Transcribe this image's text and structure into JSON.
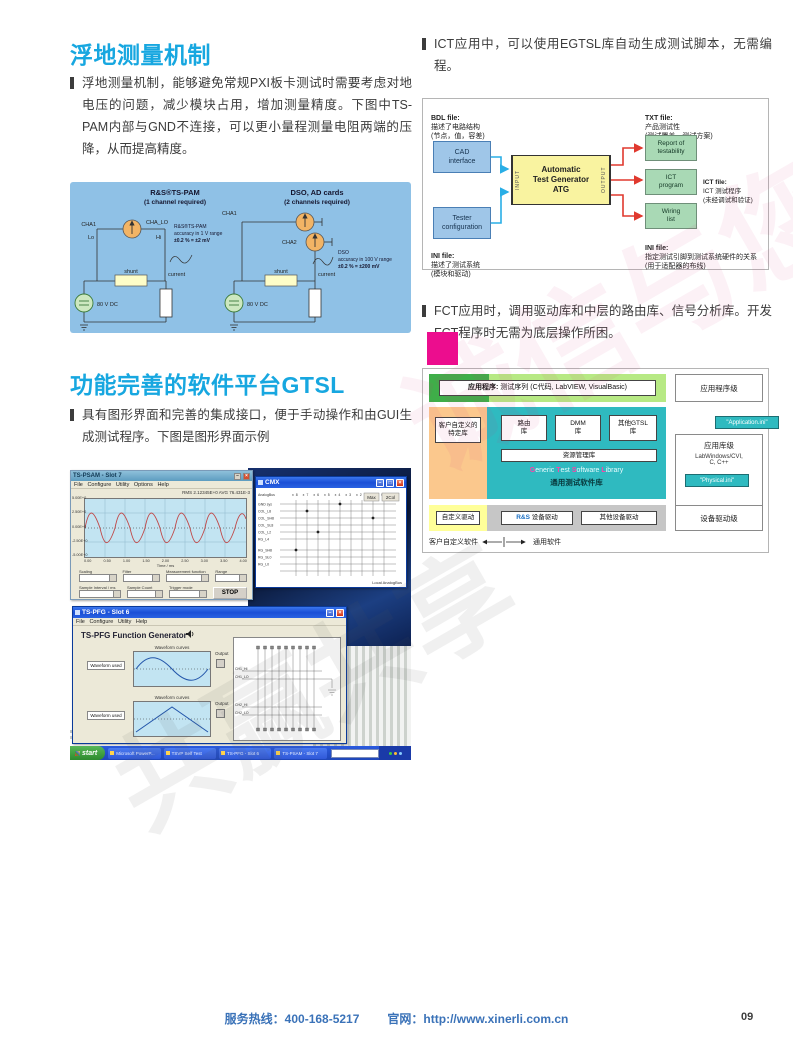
{
  "page": {
    "footer": {
      "hotline_label": "服务热线：",
      "hotline": "400-168-5217",
      "web_label": "官网：",
      "website": "http://www.xinerli.com.cn",
      "page_number": "09"
    },
    "watermark": {
      "line1": "诚信与您",
      "line2": "共赢共享"
    }
  },
  "left": {
    "section1": {
      "title": "浮地测量机制",
      "body": "浮地测量机制，能够避免常规PXI板卡测试时需要考虑对地电压的问题，减少模块占用，增加测量精度。下图中TS-PAM内部与GND不连接，可以更小量程测量电阻两端的压降，从而提高精度。"
    },
    "circuit": {
      "left_title": "R&S®TS-PAM",
      "left_subtitle": "(1 channel required)",
      "right_title": "DSO, AD cards",
      "right_subtitle": "(2 channels required)",
      "labels": {
        "cha1": "CHA1",
        "cha_lo": "CHA_LO",
        "lo": "Lo",
        "hi": "Hi",
        "cha2": "CHA2",
        "shunt": "shunt",
        "current": "current",
        "source": "80 V DC"
      },
      "left_accuracy": [
        "R&S®TS-PAM",
        "accuracy in 1 V range",
        "±0.2 % = ±2 mV"
      ],
      "right_accuracy": [
        "DSO",
        "accuracy in 100 V range",
        "±0.2 % = ±200 mV"
      ]
    },
    "section2": {
      "title": "功能完善的软件平台GTSL",
      "body": "具有图形界面和完善的集成接口，便于手动操作和由GUI生成测试程序。下图是图形界面示例"
    },
    "screenshot": {
      "psam": {
        "title": "TS-PSAM - Slot 7",
        "menu": "File   Configure   Utility   Options   Help",
        "status": "RMS 2.12345E+0    AVG 76.431E-3",
        "y_ticks": [
          "5.00E+0",
          "2.50E+0",
          "0.00E+0",
          "-2.50E+0",
          "-5.00E+0"
        ],
        "x_ticks": [
          "0.00",
          "0.50",
          "1.00",
          "1.50",
          "2.00",
          "2.50",
          "3.00",
          "3.50",
          "4.00"
        ],
        "xlabel": "Time / ms",
        "controls": [
          "Scaling",
          "Filter",
          "Measurement function",
          "Range"
        ],
        "controls2": [
          "Sample Interval / ms",
          "Sample Count",
          "Trigger mode"
        ],
        "stop": "STOP"
      },
      "cmx": {
        "title": "CMX",
        "btn_max": "Max",
        "btn_2col": "2Col",
        "top_labels": "x8  x7  x6  x5  x4  x3  x2  x1  x0",
        "left_labels": [
          "AnalogBus",
          "GND sys",
          "COL_L8",
          "COL_SH8",
          "COL_SL8",
          "COL_L2",
          "RG_L4",
          "RG_SH8",
          "RG_SL0",
          "RG_L0"
        ],
        "bottom_label": "Local AnalogBus"
      },
      "pfg": {
        "title": "TS-PFG - Slot 6",
        "menu": "File   Configure   Utility   Help",
        "heading": "TS-PFG Function Generator",
        "panel_label": "Waveform curves",
        "left_label": "Waveform used",
        "output_label": "Output",
        "ch_labels": [
          "CH1_HI",
          "CH1_LO",
          "CH2_HI",
          "CH2_LO"
        ]
      },
      "taskbar": {
        "start": "start",
        "tasks": [
          "Microsoft PowerP...",
          "TSVP Self Test",
          "TS-PFG - Slot 6",
          "TS-PSAM - Slot 7"
        ]
      }
    }
  },
  "right": {
    "para1": "ICT应用中，可以使用EGTSL库自动生成测试脚本，无需编程。",
    "atg": {
      "bdl_title": "BDL file:",
      "bdl_body": "描述了电路结构\n(节点，值，容差)",
      "cad": "CAD\ninterface",
      "tester": "Tester\nconfiguration",
      "ini_left_title": "INI file:",
      "ini_left_body": "描述了测试系统\n(模块和驱动)",
      "atg_box": "Automatic\nTest Generator\nATG",
      "input": "INPUT",
      "output": "OUTPUT",
      "txt_title": "TXT file:",
      "txt_body": "产品测试性\n(测试覆盖，测试方案)",
      "report": "Report of\ntestability",
      "ict_program": "ICT\nprogram",
      "ict_title": "ICT file:",
      "ict_body": "ICT 测试程序\n(未经调试和验证)",
      "wiring": "Wiring\nlist",
      "ini_right_title": "INI file:",
      "ini_right_body": "指定测试引脚到测试系统硬件的关系\n(用于适配器的布线)"
    },
    "para2": "FCT应用时，调用驱动库和中层的路由库、信号分析库。开发FCT程序时无需为底层操作所困。",
    "gtsl": {
      "app_bar_bold": "应用程序:",
      "app_bar_rest": " 测试序列 (C代码, LabVIEW, VisualBasic)",
      "app_level": "应用程序级",
      "custom_lib": "客户自定义的\n特定库",
      "lib1": "路由\n库",
      "lib2": "DMM\n库",
      "lib3": "其他GTSL\n库",
      "resource_lib": "资源管理库",
      "gtsl_en": {
        "g": "G",
        "eneric": "eneric ",
        "t": "T",
        "est": "est ",
        "s": "S",
        "oftware": "oftware ",
        "l": "L",
        "ibrary": "ibrary"
      },
      "gtsl_cn": "通用测试软件库",
      "application_ini": "\"Application.ini\"",
      "lib_level": "应用库级",
      "lib_level_sub": "LabWindows/CVI,\nC, C++",
      "physical_ini": "\"Physical.ini\"",
      "custom_driver": "自定义驱动",
      "rs_prefix": "R&S",
      "rs_driver": " 设备驱动",
      "other_driver": "其他设备驱动",
      "driver_level": "设备驱动级",
      "bottom_left": "客户自定义软件",
      "bottom_right": "通用软件"
    }
  }
}
